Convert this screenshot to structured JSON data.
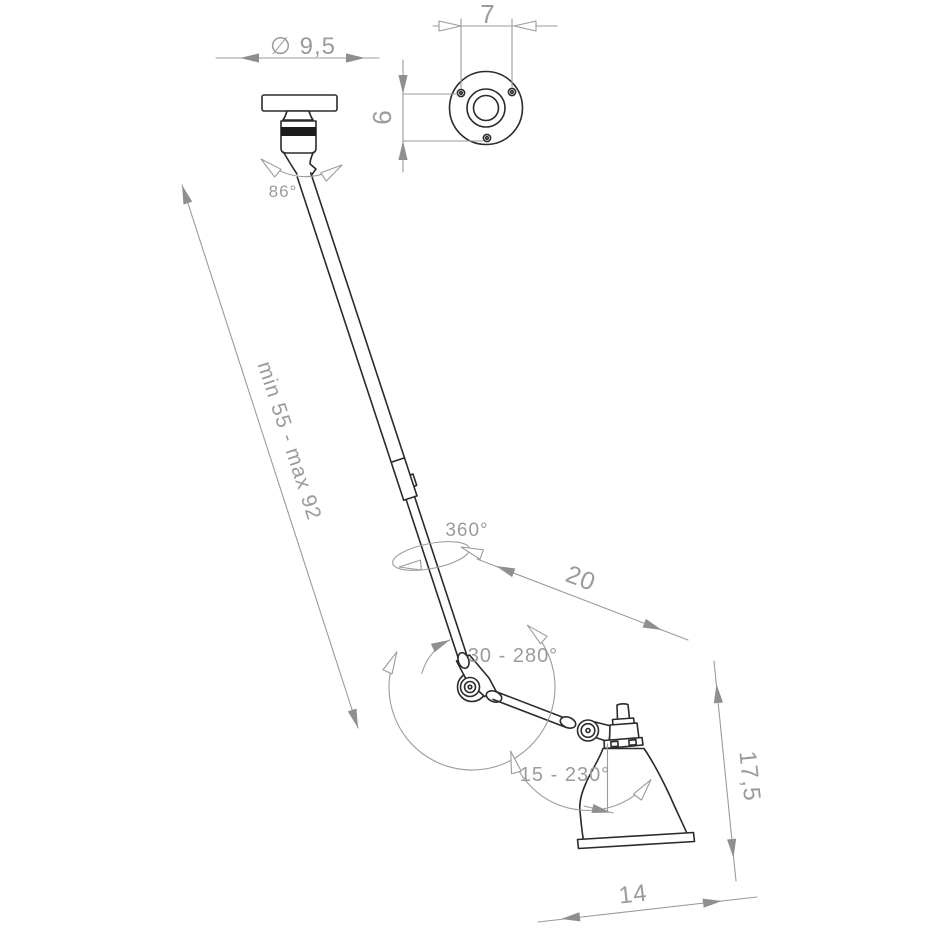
{
  "drawing": {
    "type": "technical-dimension-drawing",
    "subject": "articulated ceiling lamp"
  },
  "labels": {
    "plate_diameter": "∅ 9,5",
    "holes_width": "7",
    "holes_height": "6",
    "mount_swivel_angle": "86°",
    "arm_length_range": "min 55 - max 92",
    "arm_rotation": "360°",
    "forearm_length": "20",
    "elbow_rotation": "30 - 280°",
    "shade_rotation": "15 - 230°",
    "shade_height": "17,5",
    "shade_width": "14"
  },
  "colors": {
    "drawing_line": "#2b2b2b",
    "dimension": "#9b9b9b",
    "band_fill": "#1c1c1c",
    "background": "#ffffff"
  }
}
